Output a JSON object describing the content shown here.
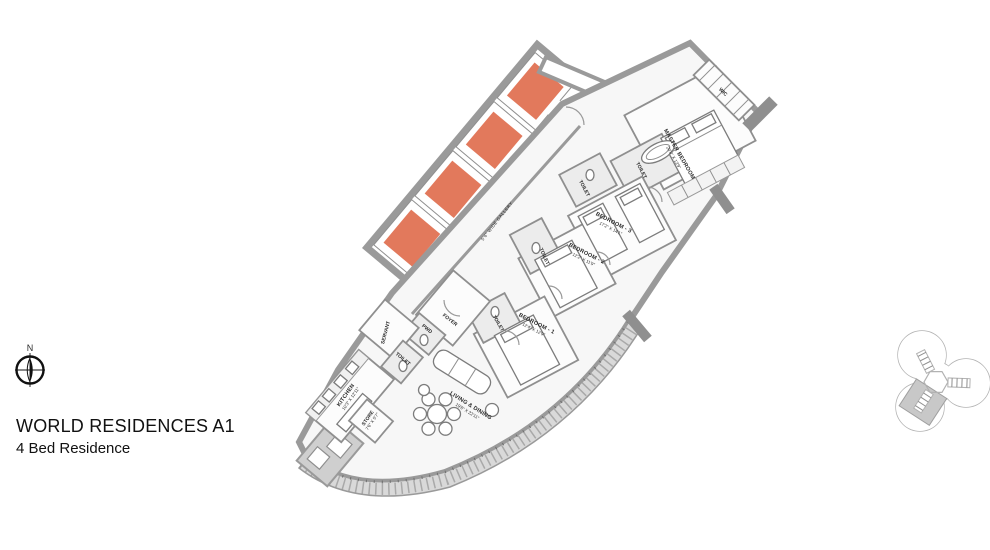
{
  "title": {
    "line1": "WORLD RESIDENCES A1",
    "line2": "4 Bed Residence"
  },
  "compass": {
    "label": "N"
  },
  "lift_lobby": {
    "label": "LIFT LOBBY",
    "lift_count": 4
  },
  "gallery": {
    "label": "5'6\" WIDE GALLERY"
  },
  "rooms": {
    "master_bedroom": {
      "name": "MASTER BEDROOM",
      "dims": "20'8\" X 13'9\""
    },
    "wic": {
      "name": "WIC"
    },
    "master_toilet": {
      "name": "TOILET"
    },
    "toilet_3": {
      "name": "TOILET"
    },
    "bedroom_3": {
      "name": "BEDROOM - 3",
      "dims": "17'2\" X 14'1\""
    },
    "bedroom_2": {
      "name": "BEDROOM - 2",
      "dims": "12'2\" X 11'9\""
    },
    "toilet_2": {
      "name": "TOILET"
    },
    "bedroom_1": {
      "name": "BEDROOM - 1",
      "dims": "12'4\" X 12'9\""
    },
    "toilet_1": {
      "name": "TOILET"
    },
    "foyer": {
      "name": "FOYER"
    },
    "pwd": {
      "name": "PWD"
    },
    "servant": {
      "name": "SERVANT"
    },
    "servant_toilet": {
      "name": "TOILET"
    },
    "kitchen": {
      "name": "KITCHEN",
      "dims": "10'3\" X 12'11\""
    },
    "store": {
      "name": "STORE",
      "dims": "7'6\" X 5'7\""
    },
    "living_dining": {
      "name": "LIVING & DINING",
      "dims": "19'6\" X 22'11\""
    }
  },
  "colors": {
    "lift_car": "#e2795c",
    "wall": "#9a9a9a",
    "balcony": "#d9d9d9",
    "keyplan_shade": "#c8c8c8"
  }
}
